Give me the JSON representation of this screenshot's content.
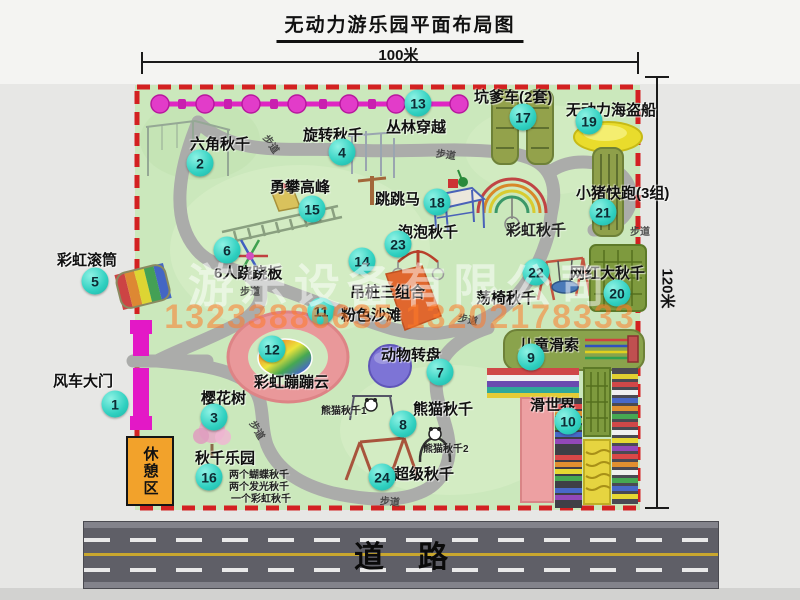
{
  "title": "无动力游乐园平面布局图",
  "dimensions": {
    "width_label": "100米",
    "height_label": "120米"
  },
  "road_label": "道路",
  "rest_area_label": "休憩区",
  "watermark": {
    "company": "游乐设备有限公司",
    "phones": "13233886635 13202178333"
  },
  "colors": {
    "map_green": "#cbe8bc",
    "border_red": "#d32121",
    "badge_teal": "#2fd0c0",
    "gate_magenta": "#e020c4",
    "chain_magenta": "#df25c3",
    "road_gray": "#5f5f67"
  },
  "attractions": [
    {
      "num": "1",
      "label": "风车大门",
      "lx": 53,
      "ly": 370,
      "bx": 115,
      "by": 404
    },
    {
      "num": "2",
      "label": "六角秋千",
      "lx": 190,
      "ly": 133,
      "bx": 200,
      "by": 163
    },
    {
      "num": "3",
      "label": "樱花树",
      "lx": 201,
      "ly": 387,
      "bx": 214,
      "by": 417
    },
    {
      "num": "4",
      "label": "旋转秋千",
      "lx": 303,
      "ly": 124,
      "bx": 342,
      "by": 152
    },
    {
      "num": "5",
      "label": "彩虹滚筒",
      "lx": 57,
      "ly": 249,
      "bx": 95,
      "by": 281
    },
    {
      "num": "6",
      "label": "6人跷跷板",
      "lx": 214,
      "ly": 262,
      "bx": 227,
      "by": 250
    },
    {
      "num": "7",
      "label": "动物转盘",
      "lx": 381,
      "ly": 344,
      "bx": 440,
      "by": 372
    },
    {
      "num": "8",
      "label": "熊猫秋千",
      "lx": 413,
      "ly": 398,
      "bx": 403,
      "by": 424
    },
    {
      "num": "9",
      "label": "儿童滑索",
      "lx": 519,
      "ly": 334,
      "bx": 531,
      "by": 357
    },
    {
      "num": "10",
      "label": "滑世界",
      "lx": 530,
      "ly": 394,
      "bx": 568,
      "by": 421
    },
    {
      "num": "11",
      "label": "粉色沙滩",
      "lx": 341,
      "ly": 304,
      "bx": 321,
      "by": 311
    },
    {
      "num": "12",
      "label": "彩虹蹦蹦云",
      "lx": 254,
      "ly": 371,
      "bx": 272,
      "by": 349
    },
    {
      "num": "13",
      "label": "丛林穿越",
      "lx": 386,
      "ly": 116,
      "bx": 418,
      "by": 103
    },
    {
      "num": "14",
      "label": "吊桩三组合",
      "lx": 350,
      "ly": 281,
      "bx": 362,
      "by": 261
    },
    {
      "num": "15",
      "label": "勇攀高峰",
      "lx": 270,
      "ly": 176,
      "bx": 312,
      "by": 209
    },
    {
      "num": "16",
      "label": "秋千乐园",
      "lx": 195,
      "ly": 447,
      "bx": 209,
      "by": 477
    },
    {
      "num": "17",
      "label": "坑爹车(2套)",
      "lx": 474,
      "ly": 86,
      "bx": 523,
      "by": 117
    },
    {
      "num": "18",
      "label": "跳跳马",
      "lx": 375,
      "ly": 188,
      "bx": 437,
      "by": 202
    },
    {
      "num": "19",
      "label": "无动力海盗船",
      "lx": 566,
      "ly": 99,
      "bx": 589,
      "by": 121
    },
    {
      "num": "20",
      "label": "网红大秋千",
      "lx": 570,
      "ly": 262,
      "bx": 617,
      "by": 293
    },
    {
      "num": "21",
      "label": "小猪快跑(3组)",
      "lx": 576,
      "ly": 182,
      "bx": 603,
      "by": 212
    },
    {
      "num": "22",
      "label": "荡椅秋千",
      "lx": 476,
      "ly": 287,
      "bx": 536,
      "by": 272
    },
    {
      "num": "23",
      "label": "泡泡秋千",
      "lx": 398,
      "ly": 221,
      "bx": 398,
      "by": 244
    },
    {
      "num": "24",
      "label": "超级秋千",
      "lx": 394,
      "ly": 463,
      "bx": 382,
      "by": 477
    }
  ],
  "extra_labels": [
    {
      "text": "彩虹秋千",
      "x": 506,
      "y": 219,
      "size": 15
    },
    {
      "text": "熊猫秋千1",
      "x": 321,
      "y": 402,
      "size": 10
    },
    {
      "text": "熊猫秋千2",
      "x": 423,
      "y": 440,
      "size": 10
    },
    {
      "text": "两个蝴蝶秋千",
      "x": 229,
      "y": 466,
      "size": 10
    },
    {
      "text": "两个发光秋千",
      "x": 229,
      "y": 478,
      "size": 10
    },
    {
      "text": "一个彩虹秋千",
      "x": 231,
      "y": 490,
      "size": 10
    }
  ],
  "path_labels": [
    {
      "text": "步道",
      "x": 262,
      "y": 136,
      "rot": 55
    },
    {
      "text": "步道",
      "x": 436,
      "y": 146,
      "rot": 8
    },
    {
      "text": "步道",
      "x": 630,
      "y": 223,
      "rot": 0
    },
    {
      "text": "步道",
      "x": 240,
      "y": 283,
      "rot": 0
    },
    {
      "text": "步道",
      "x": 458,
      "y": 311,
      "rot": 12
    },
    {
      "text": "步道",
      "x": 248,
      "y": 422,
      "rot": 60
    },
    {
      "text": "步道",
      "x": 380,
      "y": 493,
      "rot": 5
    }
  ]
}
